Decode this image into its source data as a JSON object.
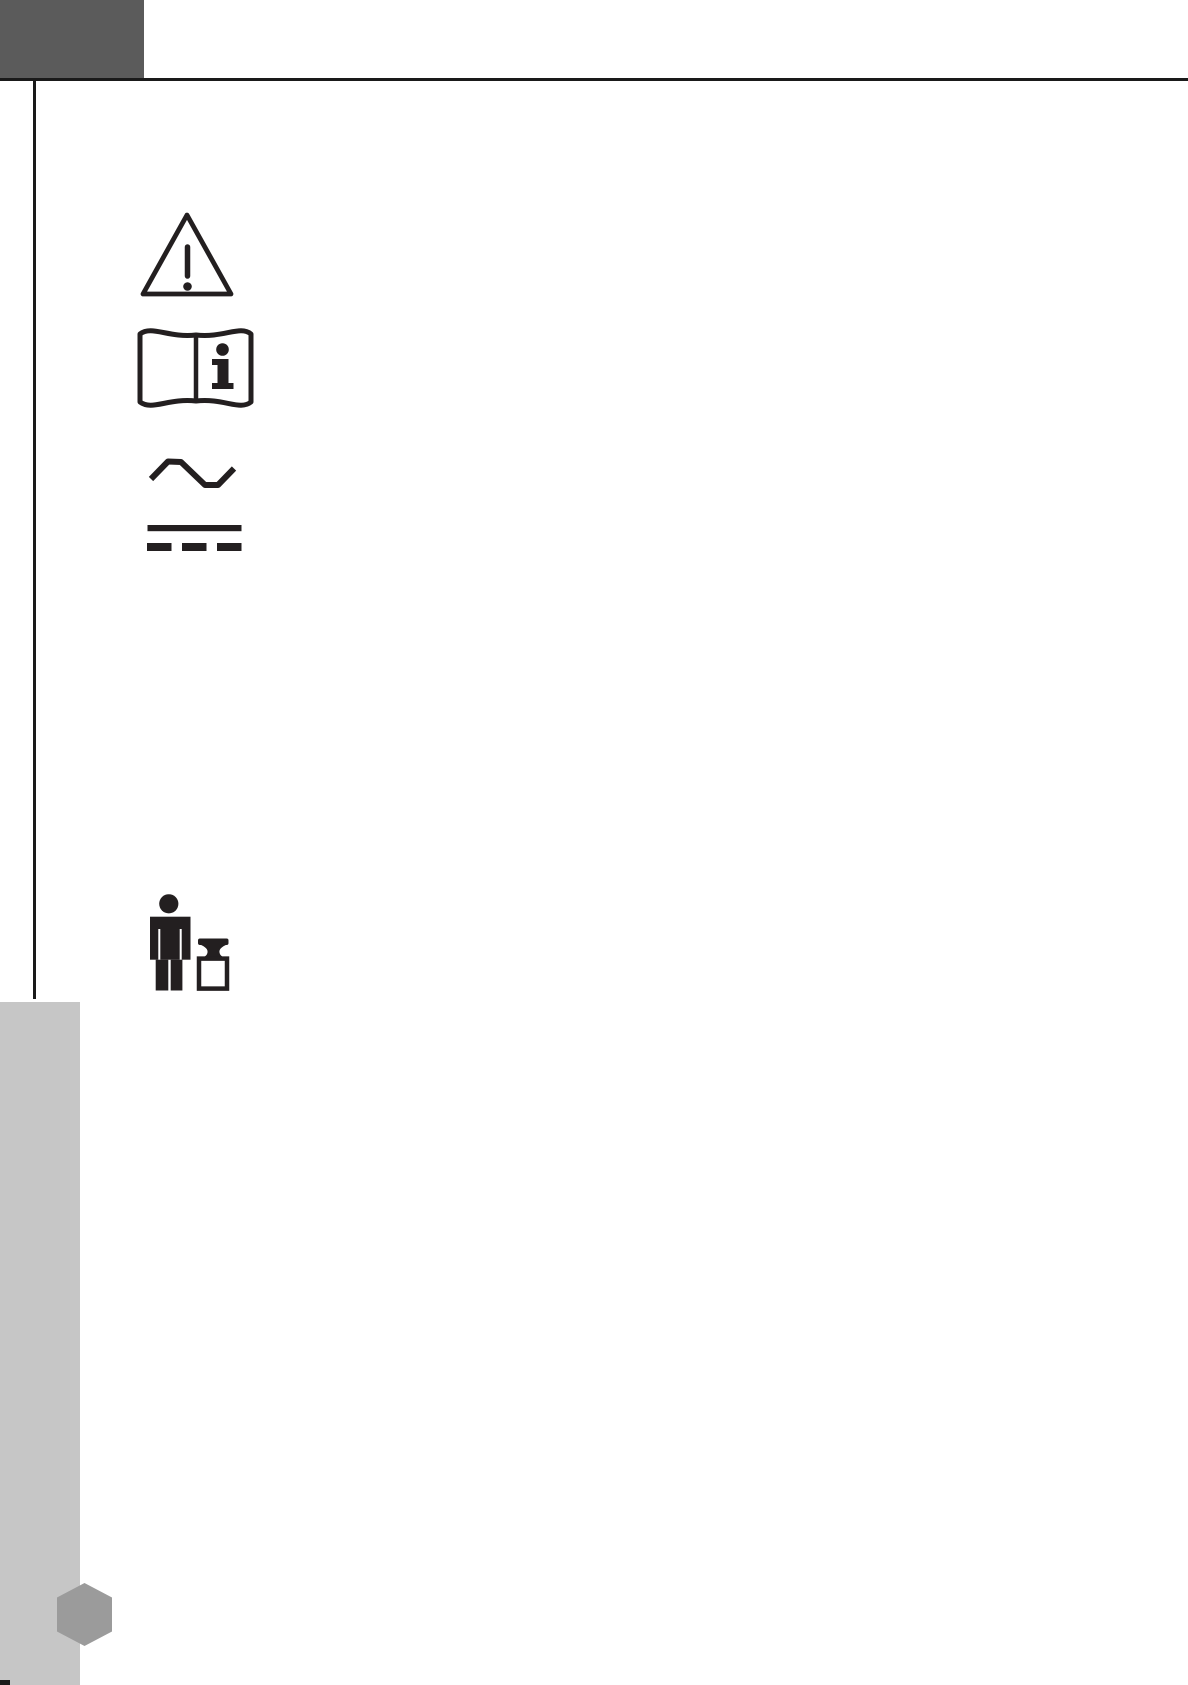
{
  "page": {
    "kind": "owner-manual-safety-symbols-page",
    "visible_text": ""
  },
  "icons": [
    {
      "name": "warning-triangle-icon"
    },
    {
      "name": "read-manual-icon"
    },
    {
      "name": "ac-current-icon"
    },
    {
      "name": "dc-current-icon"
    },
    {
      "name": "weight-limit-person-icon"
    },
    {
      "name": "hexagon-page-marker"
    }
  ],
  "colors": {
    "page-bg": "#ffffff",
    "ink": "#231f20",
    "rule-black": "#1a1a1a",
    "header-gray": "#5b5b5b",
    "sidebar-gray": "#c6c6c6",
    "hexagon-gray": "#9b9b9b"
  }
}
